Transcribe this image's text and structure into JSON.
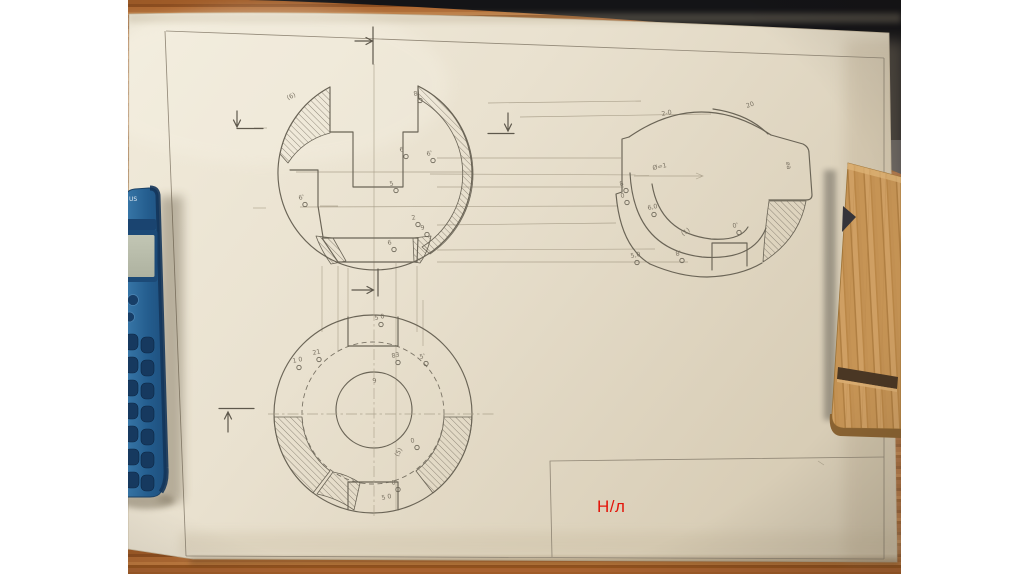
{
  "slide": {
    "background_color": "#ffffff",
    "overlay_text": "Н/л",
    "overlay_color": "#e31409"
  },
  "photo": {
    "table_wood_color": "#a4632d",
    "dark_band_color": "#141417",
    "paper_color": "#e9e1cf",
    "pencil_color": "#6a6456",
    "construction_color": "#a79d88"
  },
  "calculator": {
    "body_color": "#245d8e",
    "edge_color": "#14355a",
    "lcd_color": "#b9bdae",
    "logo_text": "US"
  },
  "clipboard": {
    "wood_color": "#c9985c",
    "slot_color": "#4a3724"
  },
  "drawing": {
    "views": {
      "front": {
        "title": "front sectional view",
        "points": [
          {
            "label": "(6)",
            "x": 288,
            "y": 100,
            "circle": false,
            "rot": -25
          },
          {
            "label": "8",
            "x": 414,
            "y": 96
          },
          {
            "label": "6",
            "x": 400,
            "y": 152
          },
          {
            "label": "6'",
            "x": 427,
            "y": 156
          },
          {
            "label": "5",
            "x": 390,
            "y": 186
          },
          {
            "label": "6'",
            "x": 299,
            "y": 200
          },
          {
            "label": "2",
            "x": 412,
            "y": 220
          },
          {
            "label": "9",
            "x": 421,
            "y": 230
          },
          {
            "label": "6",
            "x": 388,
            "y": 245
          }
        ]
      },
      "side": {
        "title": "side sectional view",
        "points": [
          {
            "label": "20",
            "x": 747,
            "y": 108,
            "circle": false,
            "rot": -20
          },
          {
            "label": "2-0",
            "x": 662,
            "y": 116,
            "circle": false
          },
          {
            "label": "Ø=1",
            "x": 653,
            "y": 170,
            "circle": false
          },
          {
            "label": "8",
            "x": 620,
            "y": 186
          },
          {
            "label": "0",
            "x": 621,
            "y": 198
          },
          {
            "label": "6,0",
            "x": 648,
            "y": 210
          },
          {
            "label": "(1)",
            "x": 683,
            "y": 236,
            "circle": false,
            "rot": -35
          },
          {
            "label": "0'",
            "x": 733,
            "y": 228
          },
          {
            "label": "8'",
            "x": 676,
            "y": 256
          },
          {
            "label": "5,0",
            "x": 631,
            "y": 258
          },
          {
            "label": "⌀a",
            "x": 786,
            "y": 162,
            "circle": false,
            "rot": 80
          }
        ]
      },
      "plan": {
        "title": "plan view",
        "points": [
          {
            "label": "5 0",
            "x": 375,
            "y": 320
          },
          {
            "label": "21",
            "x": 313,
            "y": 355
          },
          {
            "label": "1 0",
            "x": 293,
            "y": 363
          },
          {
            "label": "83",
            "x": 392,
            "y": 358
          },
          {
            "label": "5'",
            "x": 420,
            "y": 359
          },
          {
            "label": "9",
            "x": 373,
            "y": 383,
            "circle": false
          },
          {
            "label": "0",
            "x": 411,
            "y": 443
          },
          {
            "label": "(5)",
            "x": 398,
            "y": 457,
            "circle": false,
            "rot": -60
          },
          {
            "label": "0'",
            "x": 392,
            "y": 485
          },
          {
            "label": "5 0",
            "x": 382,
            "y": 500,
            "circle": false
          }
        ]
      }
    }
  }
}
